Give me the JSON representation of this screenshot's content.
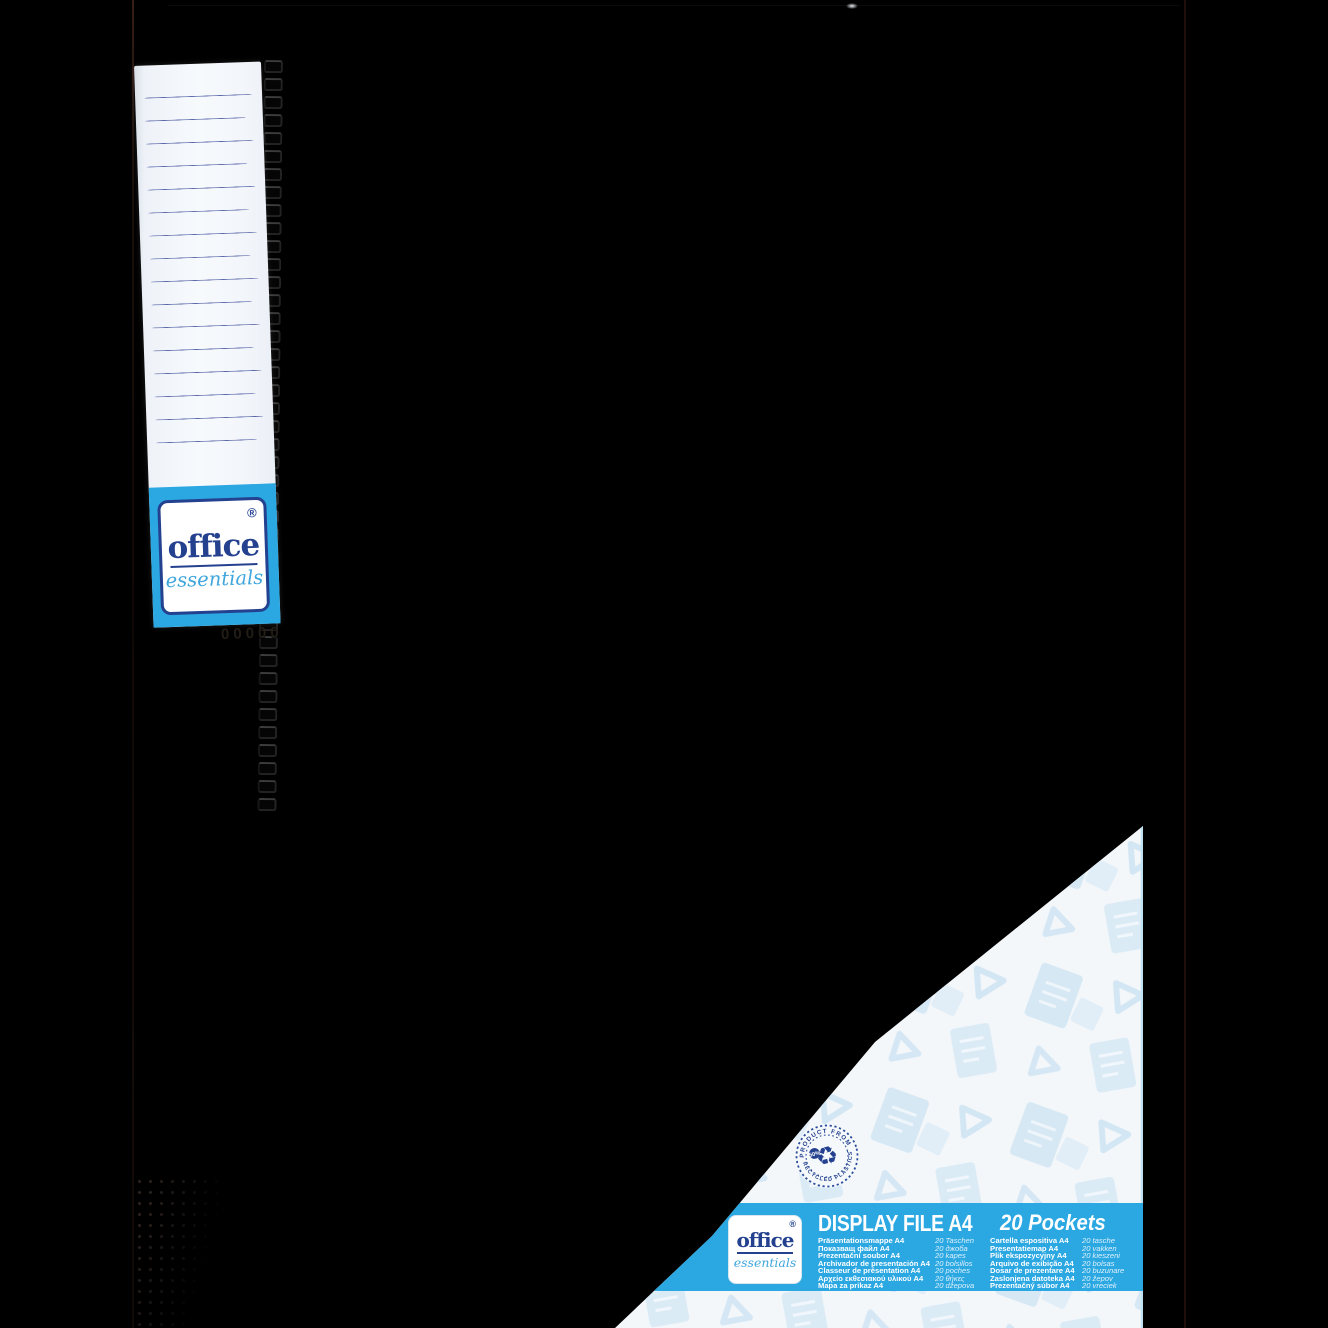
{
  "colors": {
    "background": "#000000",
    "accent_blue": "#2BA7E2",
    "brand_navy": "#24418F",
    "brand_light_blue": "#3FA6DC",
    "card_white": "#F3F7FA",
    "pattern_blue": "#C8E0F1",
    "label_line_blue": "#46549E"
  },
  "spine_label": {
    "brand": {
      "reg_mark": "®",
      "name": "office",
      "sub": "essentials"
    },
    "embossed_code": "00000"
  },
  "insert_card": {
    "recycled_badge": {
      "arc_top": "PRODUCT FROM",
      "arc_bottom": "RECYCLED PLASTICS",
      "percent": "50%",
      "icon": "recycle-icon"
    },
    "banner": {
      "brand": {
        "reg_mark": "®",
        "name": "office",
        "sub": "essentials"
      },
      "title": "DISPLAY FILE A4",
      "subtitle": "20 Pockets",
      "languages": [
        {
          "name": "Präsentationsmappe A4",
          "pockets": "20 Taschen"
        },
        {
          "name": "Показващ файл A4",
          "pockets": "20 джоба"
        },
        {
          "name": "Prezentační soubor A4",
          "pockets": "20 kapes"
        },
        {
          "name": "Archivador de presentación A4",
          "pockets": "20 bolsillos"
        },
        {
          "name": "Classeur de présentation A4",
          "pockets": "20 poches"
        },
        {
          "name": "Αρχείο εκθεσιακού υλικού A4",
          "pockets": "20 θήκες"
        },
        {
          "name": "Mapa za prikaz A4",
          "pockets": "20 džepova"
        },
        {
          "name": "Cartella espositiva A4",
          "pockets": "20 tasche"
        },
        {
          "name": "Presentatiemap A4",
          "pockets": "20 vakken"
        },
        {
          "name": "Plik ekspozycyjny A4",
          "pockets": "20 kieszeni"
        },
        {
          "name": "Arquivo de exibição A4",
          "pockets": "20 bolsas"
        },
        {
          "name": "Dosar de prezentare A4",
          "pockets": "20 buzunare"
        },
        {
          "name": "Zaslonjena datoteka A4",
          "pockets": "20 žepov"
        },
        {
          "name": "Prezentačný súbor A4",
          "pockets": "20 vreciek"
        }
      ]
    }
  }
}
